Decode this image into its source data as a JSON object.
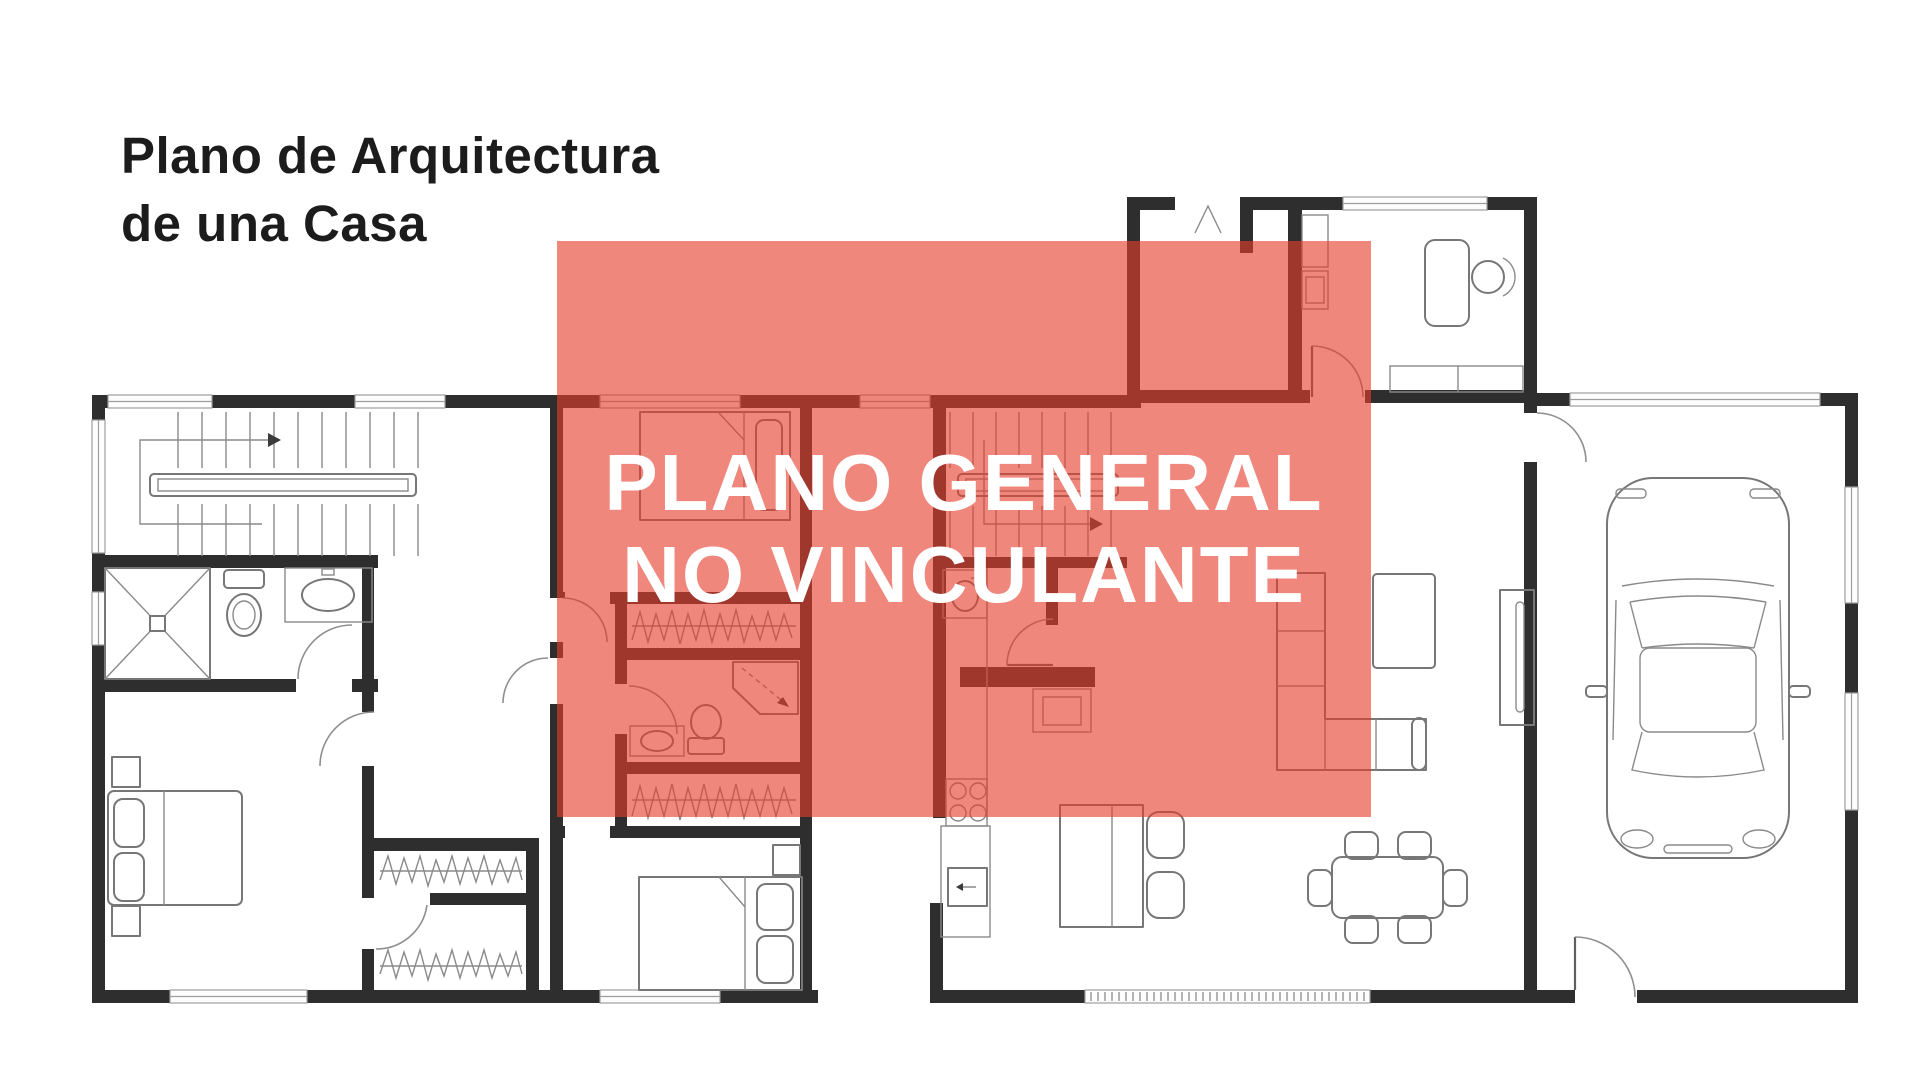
{
  "page": {
    "background": "#ffffff"
  },
  "title": {
    "line1": "Plano de Arquitectura",
    "line2": "de una Casa"
  },
  "watermark": {
    "line1": "PLANO GENERAL",
    "line2": "NO VINCULANTE"
  },
  "colors": {
    "background": "#ffffff",
    "title-text": "#1c1c1c",
    "wall": "#2e2e2e",
    "furniture-line": "#777777",
    "window-line": "#9e9e9e",
    "overlay": "rgba(229,62,45,0.62)",
    "watermark-text": "#ffffff"
  },
  "floor_plan": {
    "type": "architectural-floor-plan",
    "wings": [
      {
        "name": "left-wing",
        "rooms": [
          {
            "name": "staircase",
            "fixtures": [
              "u-stairs",
              "handrail",
              "direction-arrow"
            ]
          },
          {
            "name": "bathroom",
            "fixtures": [
              "shower",
              "toilet",
              "sink"
            ]
          },
          {
            "name": "bedroom",
            "fixtures": [
              "double-bed",
              "nightstand",
              "nightstand"
            ]
          },
          {
            "name": "closet",
            "fixtures": [
              "hanging-clothes"
            ]
          },
          {
            "name": "closet",
            "fixtures": [
              "hanging-clothes"
            ]
          }
        ]
      },
      {
        "name": "center-wing",
        "rooms": [
          {
            "name": "bedroom",
            "fixtures": [
              "bed",
              "pillow"
            ]
          },
          {
            "name": "closet",
            "fixtures": [
              "hanging-clothes"
            ]
          },
          {
            "name": "bathroom",
            "fixtures": [
              "corner-shower",
              "toilet",
              "sink"
            ]
          },
          {
            "name": "closet",
            "fixtures": [
              "hanging-clothes"
            ]
          },
          {
            "name": "bedroom",
            "fixtures": [
              "bed",
              "nightstand"
            ]
          }
        ]
      },
      {
        "name": "right-wing",
        "rooms": [
          {
            "name": "entry",
            "fixtures": [
              "front-door-mark",
              "cabinet"
            ]
          },
          {
            "name": "study",
            "fixtures": [
              "desk",
              "office-chair",
              "cabinet-row"
            ]
          },
          {
            "name": "staircase",
            "fixtures": [
              "stairs",
              "handrail",
              "direction-arrow"
            ]
          },
          {
            "name": "kitchen",
            "fixtures": [
              "sink",
              "cooktop-4-burners",
              "refrigerator",
              "island",
              "bar-stool",
              "bar-stool"
            ]
          },
          {
            "name": "living-room",
            "fixtures": [
              "l-shaped-sofa",
              "coffee-table",
              "sideboard"
            ]
          },
          {
            "name": "dining-room",
            "fixtures": [
              "dining-table",
              "chair",
              "chair",
              "chair",
              "chair",
              "chair",
              "chair"
            ]
          },
          {
            "name": "garage",
            "fixtures": [
              "car-top-view",
              "garage-door"
            ]
          }
        ]
      }
    ]
  }
}
